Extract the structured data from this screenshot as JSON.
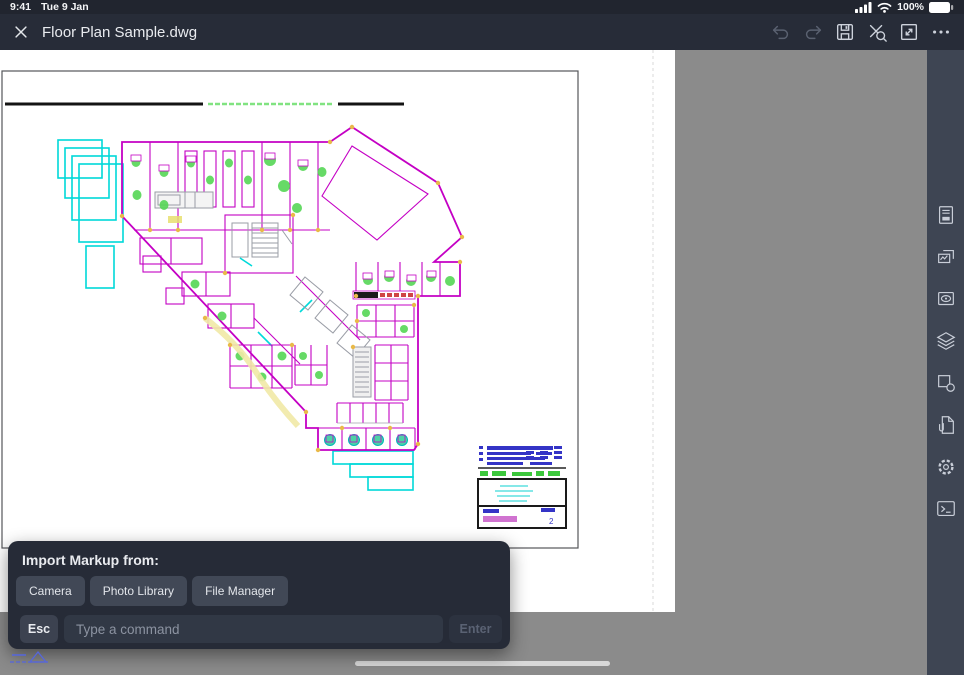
{
  "status_bar": {
    "time": "9:41",
    "date": "Tue 9 Jan",
    "battery_percent": "100%",
    "icons": [
      "cellular-signal-icon",
      "wifi-icon",
      "battery-icon"
    ]
  },
  "toolbar": {
    "title": "Floor Plan Sample.dwg",
    "icons": [
      "close-icon",
      "undo-icon",
      "redo-icon",
      "save-icon",
      "trim-zoom-icon",
      "fit-screen-icon",
      "more-icon"
    ],
    "disabled_icons": [
      "undo-icon",
      "redo-icon"
    ]
  },
  "sidebar": {
    "icons": [
      "sheets-icon",
      "layouts-icon",
      "views-icon",
      "layers-icon",
      "blocks-icon",
      "attachments-icon",
      "settings-icon",
      "command-line-icon"
    ]
  },
  "drawing": {
    "sheet_number": "2",
    "layer_colors": {
      "walls": "#C400C4",
      "glazing": "#00D9D9",
      "furniture": "#56D656",
      "junctions": "#E9B949",
      "title_text": "#3434C6",
      "core": "#9A9DA6",
      "highlight": "#F1E9A6",
      "band": "#CF4444"
    }
  },
  "popup": {
    "title": "Import Markup from:",
    "buttons": [
      "Camera",
      "Photo Library",
      "File Manager"
    ]
  },
  "command_bar": {
    "esc_label": "Esc",
    "input_placeholder": "Type a command",
    "enter_label": "Enter"
  }
}
